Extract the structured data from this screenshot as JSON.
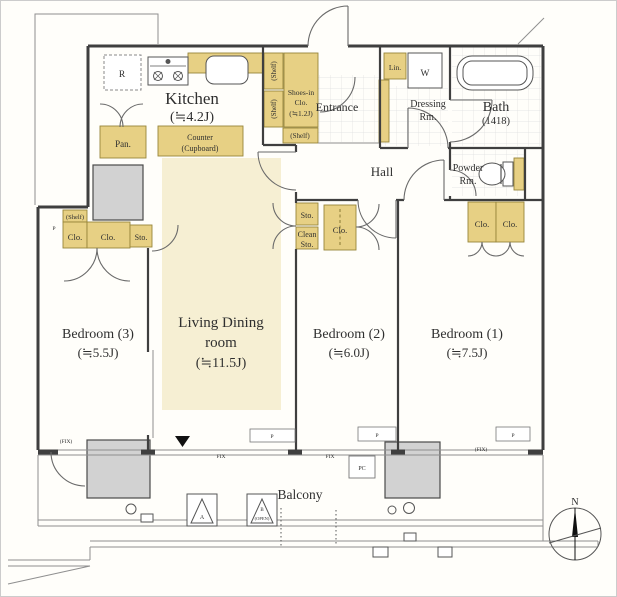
{
  "colors": {
    "storage": "#e7d084",
    "storage_border": "#97853a",
    "floor": "#f6efd3",
    "gray": "#d2d2d2",
    "wall": "#3f3f3f",
    "text": "#2f2f2f"
  },
  "rooms": {
    "kitchen": {
      "name": "Kitchen",
      "size": "(≒4.2J)"
    },
    "living": {
      "line1": "Living Dining",
      "line2": "room",
      "size": "(≒11.5J)"
    },
    "bedroom1": {
      "name": "Bedroom (1)",
      "size": "(≒7.5J)"
    },
    "bedroom2": {
      "name": "Bedroom (2)",
      "size": "(≒6.0J)"
    },
    "bedroom3": {
      "name": "Bedroom (3)",
      "size": "(≒5.5J)"
    },
    "bath": {
      "name": "Bath",
      "size": "(1418)"
    },
    "entrance": {
      "name": "Entrance"
    },
    "hall": {
      "name": "Hall"
    },
    "dressing": {
      "line1": "Dressing",
      "line2": "Rm."
    },
    "powder": {
      "line1": "Powder",
      "line2": "Rm."
    },
    "shoes": {
      "line1": "Shoes-in",
      "line2": "Clo.",
      "size": "(≒1.2J)"
    },
    "balcony": {
      "name": "Balcony"
    }
  },
  "storage": {
    "pan": "Pan.",
    "counter_line1": "Counter",
    "counter_line2": "(Cupboard)",
    "lin": "Lin.",
    "washer": "W",
    "fridge": "R",
    "shelf": "(Shelf)",
    "sto": "Sto.",
    "clean": "Clean",
    "clo": "Clo."
  },
  "annotations": {
    "fix": "FIX",
    "fix_paren": "(FIX)",
    "pillar": "P",
    "pc": "PC",
    "hatch_a": "A",
    "hatch_b": "B",
    "hatch_open": "(OPEN)",
    "north": "N"
  }
}
